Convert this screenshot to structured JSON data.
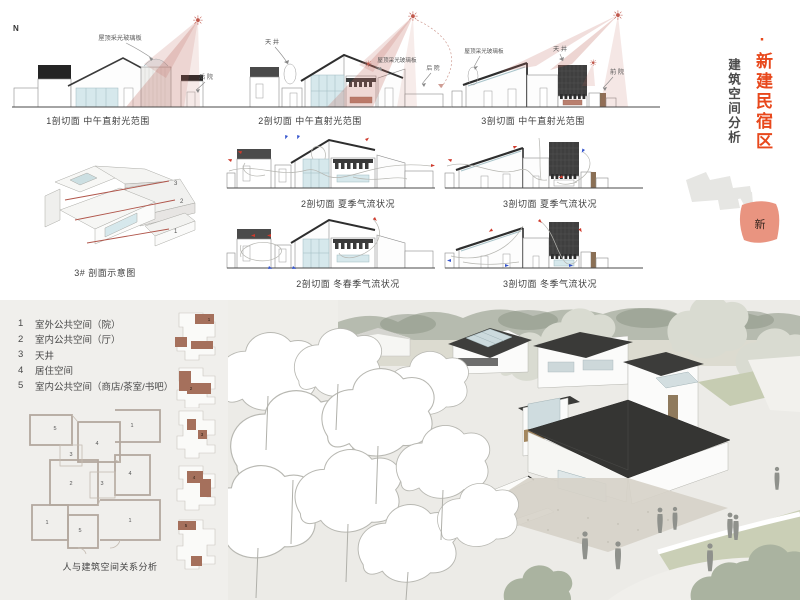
{
  "colors": {
    "accent": "#e8481c",
    "salmon": "#e99480",
    "plan_highlight": "#a5705c",
    "roof_dark": "#2e2e2e",
    "glass_blue": "#d6e8ec",
    "light_cone": "#c0695e",
    "arrow_warm": "#cf3a2c",
    "arrow_cool": "#3353cc"
  },
  "icons": {
    "sun": "☀"
  },
  "north_label": "N",
  "titles": {
    "main": "·新建民宿区",
    "sub": "建筑空间分析",
    "map_tag": "新"
  },
  "light_sections": [
    {
      "caption": "1剖切面 中午直射光范围",
      "label_roof": "屋顶采光玻璃板",
      "label_yard": "后 院"
    },
    {
      "caption": "2剖切面 中午直射光范围",
      "label_tianjing": "天 井",
      "label_roof": "屋顶采光玻璃板",
      "label_yard": "后 院"
    },
    {
      "caption": "3剖切面 中午直射光范围",
      "label_roof": "屋顶采光玻璃板",
      "label_tianjing": "天 井",
      "label_yard": "前 院"
    }
  ],
  "axon": {
    "caption": "3# 剖面示意图",
    "marks": [
      "3",
      "2",
      "1"
    ]
  },
  "airflow_sections": [
    {
      "caption": "2剖切面 夏季气流状况"
    },
    {
      "caption": "3剖切面 夏季气流状况"
    },
    {
      "caption": "2剖切面 冬春季气流状况"
    },
    {
      "caption": "3剖切面 冬季气流状况"
    }
  ],
  "legend": {
    "items": [
      {
        "num": "1",
        "label": "室外公共空间（院）"
      },
      {
        "num": "2",
        "label": "室内公共空间（厅）"
      },
      {
        "num": "3",
        "label": "天井"
      },
      {
        "num": "4",
        "label": "居住空间"
      },
      {
        "num": "5",
        "label": "室内公共空间（商店/茶室/书吧）"
      }
    ],
    "thumbs": [
      "1",
      "2",
      "3",
      "4",
      "5"
    ],
    "plan_rooms": [
      "5",
      "4",
      "1",
      "3",
      "2",
      "3",
      "4",
      "1",
      "5",
      "1"
    ],
    "caption": "人与建筑空间关系分析"
  }
}
